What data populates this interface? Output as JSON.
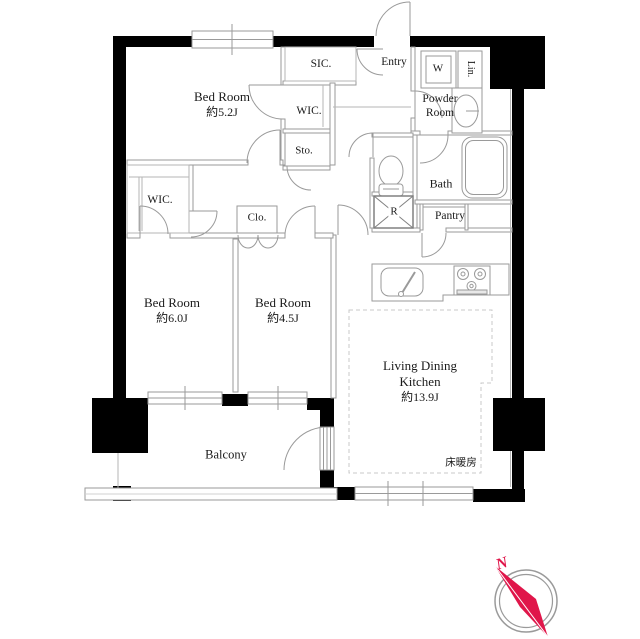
{
  "plan": {
    "rooms": {
      "bedroom1": {
        "name": "Bed Room",
        "size": "約5.2J"
      },
      "bedroom2": {
        "name": "Bed Room",
        "size": "約6.0J"
      },
      "bedroom3": {
        "name": "Bed Room",
        "size": "約4.5J"
      },
      "ldk": {
        "line1": "Living Dining",
        "line2": "Kitchen",
        "size": "約13.9J"
      },
      "balcony": "Balcony",
      "entry": "Entry",
      "sic": "SIC.",
      "wic_upper": "WIC.",
      "wic_lower": "WIC.",
      "storage": "Sto.",
      "closet": "Clo.",
      "powder": {
        "line1": "Powder",
        "line2": "Room"
      },
      "bath": "Bath",
      "pantry": "Pantry",
      "washer": "W",
      "linen": "Lin.",
      "refrigerator": "R",
      "floor_heating": "床暖房"
    },
    "compass": {
      "north": "N"
    },
    "colors": {
      "wall": "#000000",
      "partition": "#9a9a9a",
      "text": "#1a1a1a",
      "compass": "#e0164a"
    }
  }
}
